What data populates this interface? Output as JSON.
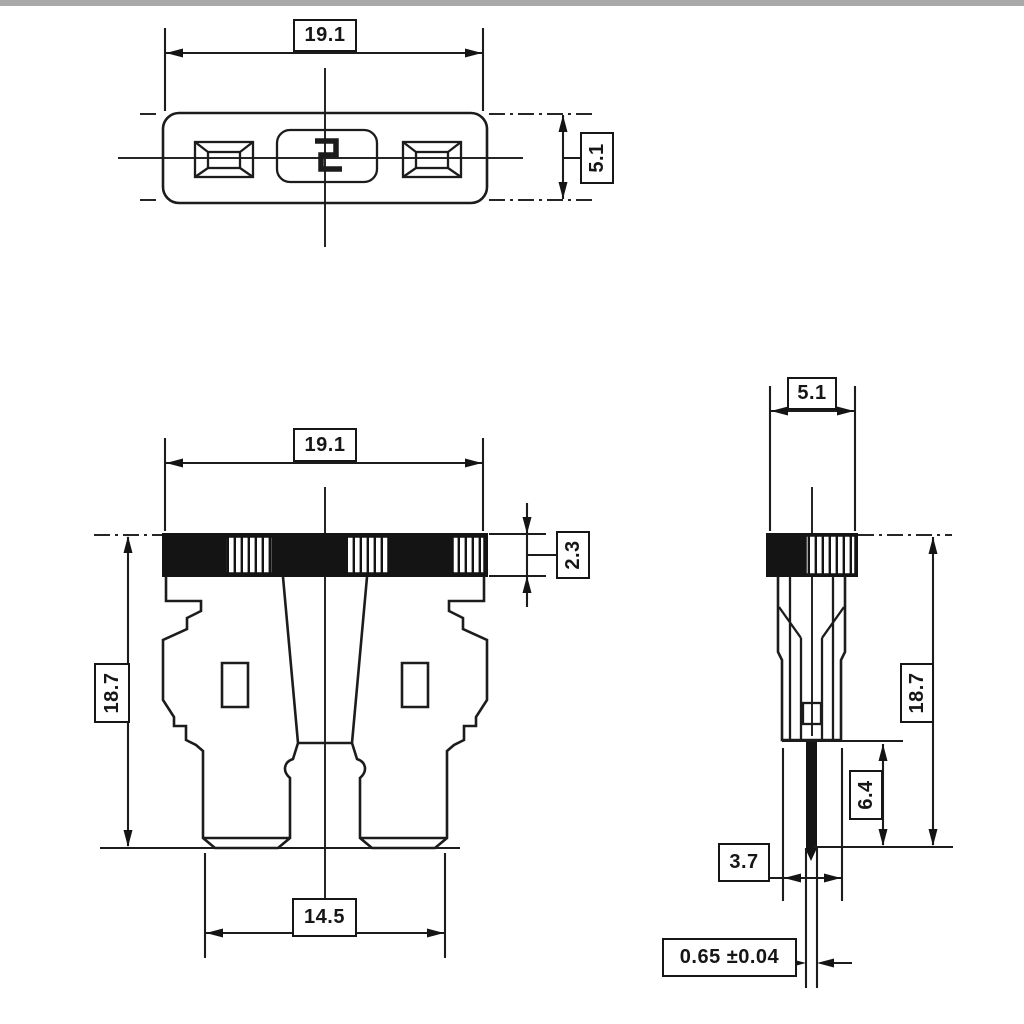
{
  "drawing_title": "Blade fuse dimensional drawing (three orthographic views)",
  "units": "mm",
  "colors": {
    "ink": "#1c1c1c",
    "paper": "#ffffff",
    "cap_fill": "#141414"
  },
  "views": {
    "top": {
      "name": "top view",
      "width_mm": "19.1",
      "thickness_mm": "5.1"
    },
    "front": {
      "name": "front view",
      "width_mm": "19.1",
      "height_mm": "18.7",
      "cap_height_mm": "2.3",
      "terminal_span_mm": "14.5"
    },
    "side": {
      "name": "side view",
      "thickness_mm": "5.1",
      "height_mm": "18.7",
      "terminal_length_mm": "6.4",
      "body_bottom_width_mm": "3.7",
      "terminal_thickness_mm": "0.65 ±0.04"
    }
  }
}
